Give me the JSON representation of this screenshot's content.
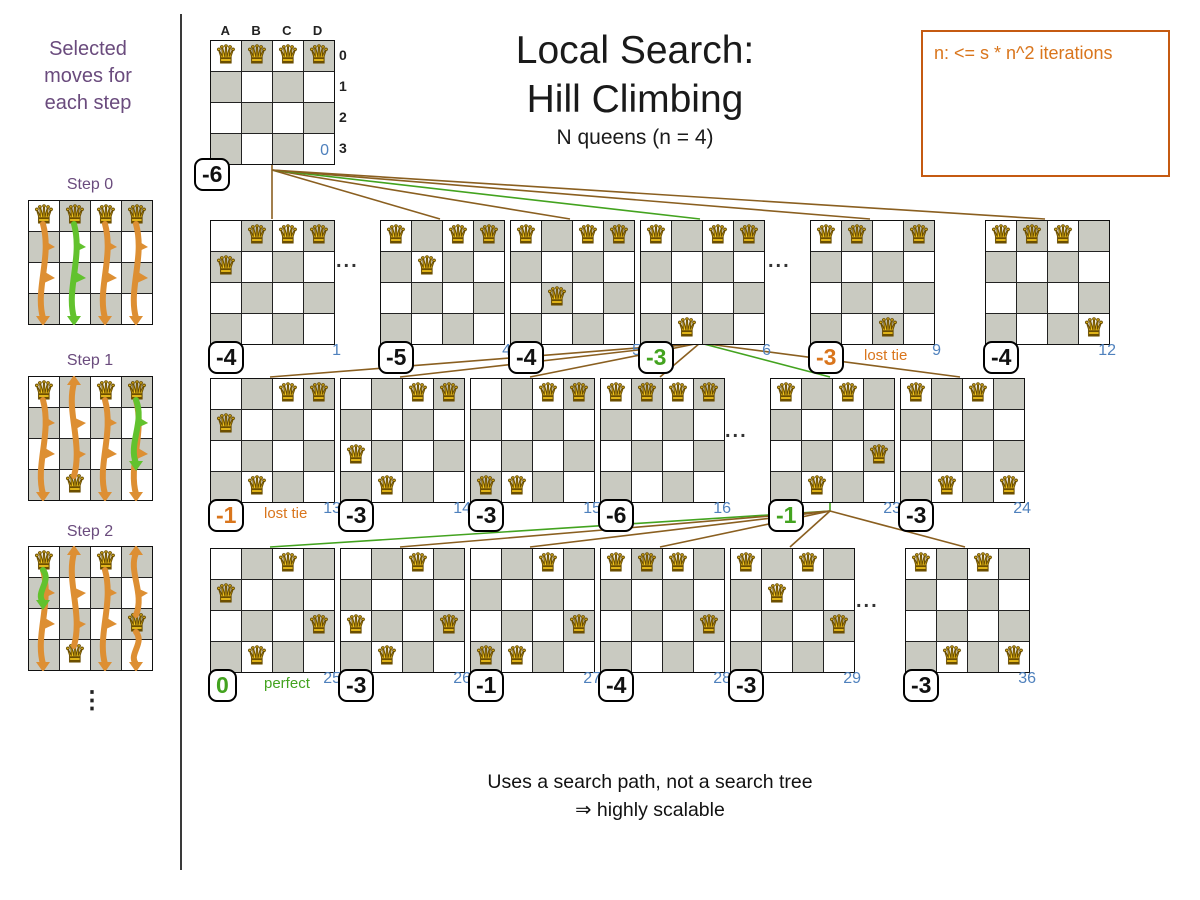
{
  "colors": {
    "purple": "#6a4b7d",
    "orange": "#d9751c",
    "green": "#43a31f",
    "blue": "#4f81bd",
    "brown": "#8a5f20",
    "board_dark": "#c9cac1",
    "arrow_orange": "#dd8f33",
    "arrow_green": "#62c22e"
  },
  "icons": {
    "queen": "♛"
  },
  "sidebar": {
    "title": "Selected moves for each step",
    "more_indicator": "⋮",
    "steps": [
      {
        "label": "Step 0",
        "queens": [
          "A0",
          "B0",
          "C0",
          "D0"
        ],
        "arrows": [
          {
            "col": 0,
            "from": 0,
            "to": 3,
            "color": "orange"
          },
          {
            "col": 1,
            "from": 0,
            "to": 3,
            "color": "green"
          },
          {
            "col": 2,
            "from": 0,
            "to": 3,
            "color": "orange"
          },
          {
            "col": 3,
            "from": 0,
            "to": 3,
            "color": "orange"
          }
        ]
      },
      {
        "label": "Step 1",
        "queens": [
          "A0",
          "C0",
          "D0",
          "B3"
        ],
        "arrows": [
          {
            "col": 0,
            "from": 0,
            "to": 3,
            "color": "orange"
          },
          {
            "col": 1,
            "from": 3,
            "to": 0,
            "color": "orange"
          },
          {
            "col": 2,
            "from": 0,
            "to": 3,
            "color": "orange"
          },
          {
            "col": 3,
            "from": 0,
            "to": 3,
            "color": "orange"
          },
          {
            "col": 3,
            "from": 0,
            "to": 2,
            "color": "green"
          }
        ]
      },
      {
        "label": "Step 2",
        "queens": [
          "A0",
          "C0",
          "B3",
          "D2"
        ],
        "arrows": [
          {
            "col": 0,
            "from": 0,
            "to": 3,
            "color": "orange"
          },
          {
            "col": 0,
            "from": 0,
            "to": 1,
            "color": "green"
          },
          {
            "col": 1,
            "from": 3,
            "to": 0,
            "color": "orange"
          },
          {
            "col": 2,
            "from": 0,
            "to": 3,
            "color": "orange"
          },
          {
            "col": 3,
            "from": 2,
            "to": 0,
            "color": "orange"
          },
          {
            "col": 3,
            "from": 2,
            "to": 3,
            "color": "orange"
          }
        ]
      }
    ]
  },
  "header": {
    "title_line1": "Local Search:",
    "title_line2": "Hill Climbing",
    "subtitle": "N queens (n = 4)",
    "note_box": {
      "text": "n: <= s * n^2 iterations"
    }
  },
  "tree": {
    "ellipsis": "...",
    "root": {
      "queens": [
        "A0",
        "B0",
        "C0",
        "D0"
      ],
      "score": "-6",
      "index": "0",
      "col_headers": [
        "A",
        "B",
        "C",
        "D"
      ],
      "row_headers": [
        "0",
        "1",
        "2",
        "3"
      ]
    },
    "levels": [
      [
        {
          "queens": [
            "B0",
            "C0",
            "D0",
            "A1"
          ],
          "score": "-4",
          "index": "1",
          "score_style": "neutral"
        },
        {
          "queens": [
            "A0",
            "C0",
            "D0",
            "B1"
          ],
          "score": "-5",
          "index": "4",
          "score_style": "neutral"
        },
        {
          "queens": [
            "A0",
            "C0",
            "D0",
            "B2"
          ],
          "score": "-4",
          "index": "5",
          "score_style": "neutral"
        },
        {
          "queens": [
            "A0",
            "C0",
            "D0",
            "B3"
          ],
          "score": "-3",
          "index": "6",
          "score_style": "selected"
        },
        {
          "queens": [
            "A0",
            "B0",
            "D0",
            "C3"
          ],
          "score": "-3",
          "index": "9",
          "score_style": "lost",
          "tag": "lost tie"
        },
        {
          "queens": [
            "A0",
            "B0",
            "C0",
            "D3"
          ],
          "score": "-4",
          "index": "12",
          "score_style": "neutral"
        }
      ],
      [
        {
          "queens": [
            "C0",
            "D0",
            "A1",
            "B3"
          ],
          "score": "-1",
          "index": "13",
          "score_style": "lost",
          "tag": "lost tie"
        },
        {
          "queens": [
            "C0",
            "D0",
            "A2",
            "B3"
          ],
          "score": "-3",
          "index": "14",
          "score_style": "neutral"
        },
        {
          "queens": [
            "C0",
            "D0",
            "A3",
            "B3"
          ],
          "score": "-3",
          "index": "15",
          "score_style": "neutral"
        },
        {
          "queens": [
            "A0",
            "B0",
            "C0",
            "D0"
          ],
          "score": "-6",
          "index": "16",
          "score_style": "neutral"
        },
        {
          "queens": [
            "A0",
            "C0",
            "D2",
            "B3"
          ],
          "score": "-1",
          "index": "23",
          "score_style": "selected"
        },
        {
          "queens": [
            "A0",
            "C0",
            "B3",
            "D3"
          ],
          "score": "-3",
          "index": "24",
          "score_style": "neutral"
        }
      ],
      [
        {
          "queens": [
            "C0",
            "A1",
            "D2",
            "B3"
          ],
          "score": "0",
          "index": "25",
          "score_style": "selected",
          "tag": "perfect"
        },
        {
          "queens": [
            "C0",
            "A2",
            "D2",
            "B3"
          ],
          "score": "-3",
          "index": "26",
          "score_style": "neutral"
        },
        {
          "queens": [
            "C0",
            "D2",
            "A3",
            "B3"
          ],
          "score": "-1",
          "index": "27",
          "score_style": "neutral"
        },
        {
          "queens": [
            "A0",
            "B0",
            "C0",
            "D2"
          ],
          "score": "-4",
          "index": "28",
          "score_style": "neutral"
        },
        {
          "queens": [
            "A0",
            "C0",
            "B1",
            "D2"
          ],
          "score": "-3",
          "index": "29",
          "score_style": "neutral"
        },
        {
          "queens": [
            "A0",
            "C0",
            "B3",
            "D3"
          ],
          "score": "-3",
          "index": "36",
          "score_style": "neutral"
        }
      ]
    ]
  },
  "footer": {
    "line1": "Uses a search path, not a search tree",
    "line2": "⇒ highly scalable"
  }
}
